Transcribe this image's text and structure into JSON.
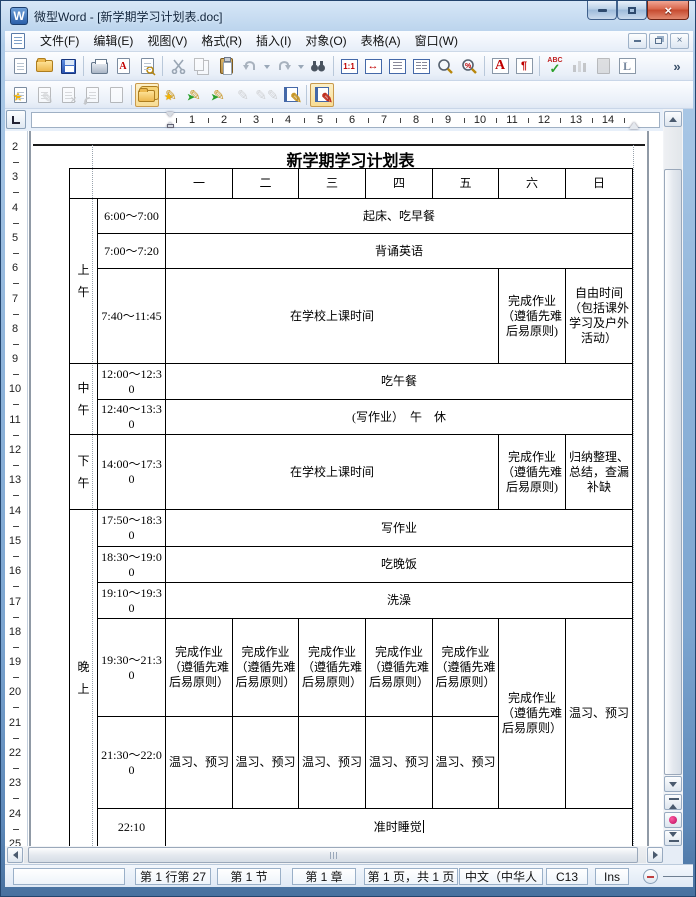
{
  "window": {
    "title": "微型Word - [新学期学习计划表.doc]",
    "app_initial": "W"
  },
  "menu": {
    "items": [
      "文件(F)",
      "编辑(E)",
      "视图(V)",
      "格式(R)",
      "插入(I)",
      "对象(O)",
      "表格(A)",
      "窗口(W)"
    ]
  },
  "icons": {
    "overflow": "»",
    "zoom_100": "1:1",
    "fit_width": "↔",
    "font_color": "A",
    "pdf_letter": "A",
    "paragraph": "¶",
    "spellcheck": "ABC",
    "letter_l": "L",
    "pencil": "✎",
    "star": "★",
    "arrow": "➤",
    "zoom_percent": "%"
  },
  "ruler": {
    "h_numbers": [
      "1",
      "2",
      "3",
      "4",
      "5",
      "6",
      "7",
      "8",
      "9",
      "10",
      "11",
      "12",
      "13",
      "14"
    ],
    "v_numbers": [
      "2",
      "3",
      "4",
      "5",
      "6",
      "7",
      "8",
      "9",
      "10",
      "11",
      "12",
      "13",
      "14",
      "15",
      "16",
      "17",
      "18",
      "19",
      "20",
      "21",
      "22",
      "23",
      "24",
      "25"
    ]
  },
  "document": {
    "title": "新学期学习计划表"
  },
  "table": {
    "col_widths": [
      28,
      68,
      67,
      66,
      67,
      67,
      66,
      67,
      67
    ],
    "rows": [
      {
        "h": 30,
        "cells": [
          {
            "t": "",
            "cs": 2
          },
          {
            "t": "一"
          },
          {
            "t": "二"
          },
          {
            "t": "三"
          },
          {
            "t": "四"
          },
          {
            "t": "五"
          },
          {
            "t": "六"
          },
          {
            "t": "日"
          }
        ]
      },
      {
        "h": 35,
        "cells": [
          {
            "t": "上午",
            "rs": 3,
            "cls": "period"
          },
          {
            "t": "6:00～7:00",
            "cls": "time"
          },
          {
            "t": "起床、吃早餐",
            "cs": 7
          }
        ]
      },
      {
        "h": 35,
        "cells": [
          {
            "t": "7:00～7:20",
            "cls": "time"
          },
          {
            "t": "背诵英语",
            "cs": 7
          }
        ]
      },
      {
        "h": 95,
        "cells": [
          {
            "t": "7:40～11:45",
            "cls": "time"
          },
          {
            "t": "在学校上课时间",
            "cs": 5
          },
          {
            "t": "完成作业（遵循先难后易原则)"
          },
          {
            "t": "自由时间（包括课外学习及户外活动）"
          }
        ]
      },
      {
        "h": 36,
        "cells": [
          {
            "t": "中午",
            "rs": 2,
            "cls": "period"
          },
          {
            "t": "12:00～12:30",
            "cls": "time"
          },
          {
            "t": "吃午餐",
            "cs": 7
          }
        ]
      },
      {
        "h": 35,
        "cells": [
          {
            "t": "12:40～13:30",
            "cls": "time"
          },
          {
            "t": "(写作业）　午　休",
            "cs": 7
          }
        ]
      },
      {
        "h": 75,
        "cells": [
          {
            "t": "下午",
            "cls": "period"
          },
          {
            "t": "14:00～17:30",
            "cls": "time"
          },
          {
            "t": "在学校上课时间",
            "cs": 5
          },
          {
            "t": "完成作业（遵循先难后易原则)"
          },
          {
            "t": "归纳整理、总结，查漏补缺"
          }
        ]
      },
      {
        "h": 37,
        "cells": [
          {
            "t": "晚上",
            "rs": 6,
            "cls": "period"
          },
          {
            "t": "17:50～18:30",
            "cls": "time"
          },
          {
            "t": "写作业",
            "cs": 7
          }
        ]
      },
      {
        "h": 36,
        "cells": [
          {
            "t": "18:30～19:00",
            "cls": "time"
          },
          {
            "t": "吃晚饭",
            "cs": 7
          }
        ]
      },
      {
        "h": 36,
        "cells": [
          {
            "t": "19:10～19:30",
            "cls": "time"
          },
          {
            "t": "洗澡",
            "cs": 7
          }
        ]
      },
      {
        "h": 98,
        "cells": [
          {
            "t": "19:30～21:30",
            "cls": "time"
          },
          {
            "t": "完成作业（遵循先难后易原则）"
          },
          {
            "t": "完成作业（遵循先难后易原则）"
          },
          {
            "t": "完成作业（遵循先难后易原则）"
          },
          {
            "t": "完成作业（遵循先难后易原则）"
          },
          {
            "t": "完成作业（遵循先难后易原则）"
          },
          {
            "t": "完成作业（遵循先难后易原则）",
            "rs": 2
          },
          {
            "t": "温习、预习",
            "rs": 2
          }
        ]
      },
      {
        "h": 92,
        "cells": [
          {
            "t": "21:30～22:00",
            "cls": "time"
          },
          {
            "t": "温习、预习"
          },
          {
            "t": "温习、预习"
          },
          {
            "t": "温习、预习"
          },
          {
            "t": "温习、预习"
          },
          {
            "t": "温习、预习"
          }
        ]
      },
      {
        "h": 38,
        "cells": [
          {
            "t": "22:10",
            "cls": "time"
          },
          {
            "t": "准时睡觉",
            "cs": 7,
            "cursor": true
          }
        ]
      }
    ]
  },
  "statusbar": {
    "items": [
      "第 1 行第 27",
      "第 1 节",
      "第 1 章",
      "第 1 页，共 1 页",
      "中文（中华人",
      "C13",
      "Ins"
    ]
  }
}
